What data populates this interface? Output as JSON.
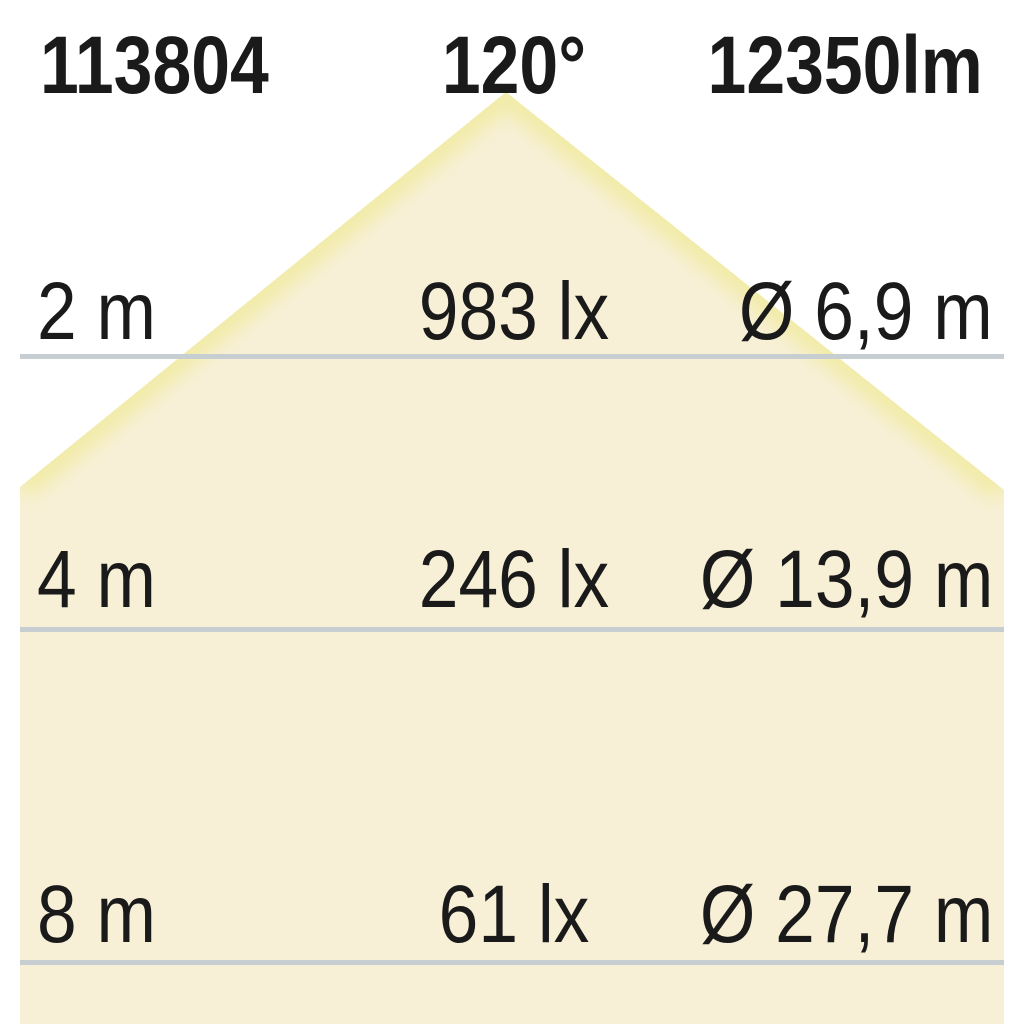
{
  "product": {
    "article_number": "113804",
    "beam_angle": "120°",
    "luminous_flux": "12350lm"
  },
  "rows": [
    {
      "distance": "2 m",
      "illuminance": "983 lx",
      "beam_diameter": "Ø 6,9 m"
    },
    {
      "distance": "4 m",
      "illuminance": "246 lx",
      "beam_diameter": "Ø 13,9 m"
    },
    {
      "distance": "8 m",
      "illuminance": "61 lx",
      "beam_diameter": "Ø 27,7 m"
    }
  ],
  "colors": {
    "background": "#ffffff",
    "cone_fill": "#f7f0d7",
    "cone_edge": "#f2eba8",
    "line": "#c6ced2",
    "text": "#1a1a1a"
  },
  "chart_data": {
    "type": "table",
    "title": "Light cone distribution diagram",
    "article_number": "113804",
    "beam_angle_deg": 120,
    "luminous_flux_lm": 12350,
    "columns": [
      "distance_m",
      "illuminance_lx",
      "beam_diameter_m"
    ],
    "rows": [
      [
        2,
        983,
        6.9
      ],
      [
        4,
        246,
        13.9
      ],
      [
        8,
        61,
        27.7
      ]
    ]
  }
}
